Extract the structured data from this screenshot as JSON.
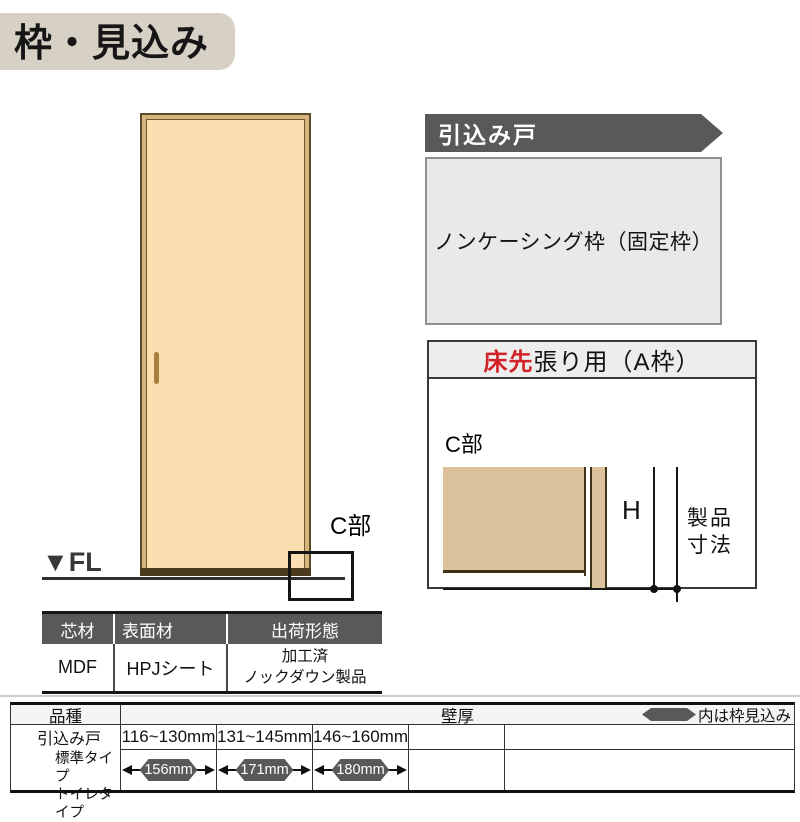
{
  "page": {
    "title": "枠・見込み"
  },
  "door_figure": {
    "fl_label": "▼FL",
    "c_section_label": "C部"
  },
  "right_column": {
    "banner_label": "引込み戸",
    "frame_type": "ノンケーシング枠（固定枠）"
  },
  "a_frame": {
    "header_red": "床先",
    "header_black": "張り用（A枠）",
    "c_detail_label": "C部",
    "h_label": "H",
    "product_dim_line1": "製品",
    "product_dim_line2": "寸法"
  },
  "materials_table": {
    "headers": [
      "芯材",
      "表面材",
      "出荷形態"
    ],
    "core": "MDF",
    "surface": "HPJシート",
    "shipping_lines": [
      "加工済",
      "ノックダウン製品"
    ]
  },
  "spec_table": {
    "product_header": "品種",
    "wall_header": "壁厚",
    "legend_note": "内は枠見込み",
    "product_name": "引込み戸",
    "product_types": [
      "標準タイプ",
      "トイレタイプ"
    ],
    "columns": [
      {
        "wall_range": "116~130mm",
        "frame_depth": "156mm"
      },
      {
        "wall_range": "131~145mm",
        "frame_depth": "171mm"
      },
      {
        "wall_range": "146~160mm",
        "frame_depth": "180mm"
      }
    ]
  },
  "colors": {
    "accent_gray": "#595959",
    "red": "#d2232a",
    "door_fill": "#fcdfb1",
    "door_trim": "#d6b47e",
    "cross_section_tan": "#dcc19d",
    "panel_gray": "#e9e9e9",
    "title_bg": "#d6d0c5"
  }
}
